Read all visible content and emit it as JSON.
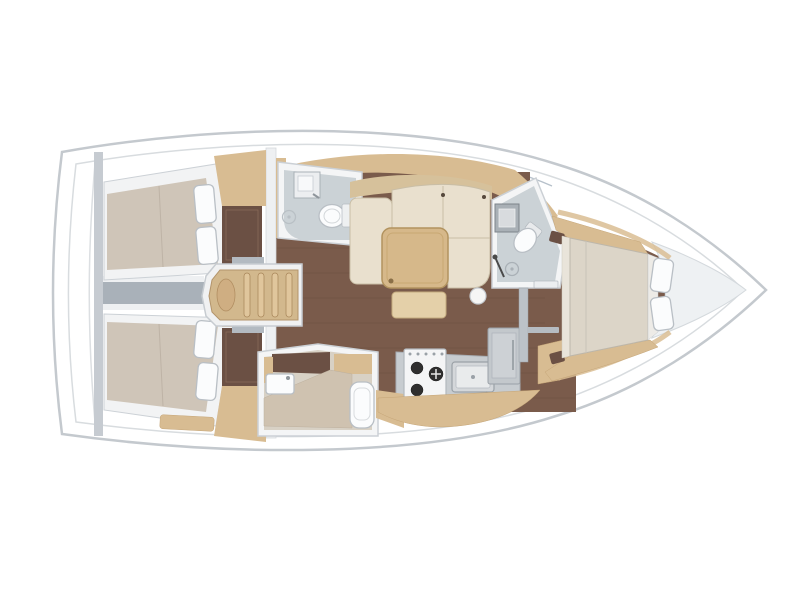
{
  "diagram": {
    "type": "sailboat-interior-floor-plan",
    "orientation": "bow-right",
    "rooms": [
      {
        "id": "aft-cabin-port",
        "fixtures": [
          "double-berth",
          "pillow",
          "pillow",
          "wardrobe",
          "locker-niche"
        ]
      },
      {
        "id": "aft-cabin-starboard",
        "fixtures": [
          "double-berth",
          "pillow",
          "pillow",
          "wardrobe",
          "locker-niche"
        ]
      },
      {
        "id": "companionway",
        "fixtures": [
          "steps"
        ]
      },
      {
        "id": "aft-head",
        "fixtures": [
          "sink",
          "toilet",
          "shower-drain"
        ]
      },
      {
        "id": "mid-head",
        "fixtures": [
          "sink",
          "toilet",
          "shower-bench"
        ]
      },
      {
        "id": "salon",
        "fixtures": [
          "l-sofa",
          "dining-table",
          "coffee-table",
          "stool"
        ]
      },
      {
        "id": "galley",
        "fixtures": [
          "stove",
          "sink",
          "fridge",
          "counter"
        ]
      },
      {
        "id": "forward-head",
        "fixtures": [
          "sink",
          "toilet",
          "shower-drain",
          "shower-wand"
        ]
      },
      {
        "id": "forward-cabin",
        "fixtures": [
          "double-berth",
          "pillow",
          "pillow",
          "bench",
          "bench"
        ]
      },
      {
        "id": "bow-locker",
        "fixtures": []
      }
    ]
  },
  "palette": {
    "deckWhite": "#ffffff",
    "hullLine": "#c4c9ce",
    "innerLine": "#d8dcdf",
    "floorWood": "#7a5b4b",
    "woodCabinet": "#d8bc92",
    "woodTable": "#d6b88a",
    "stepsWood": "#d2b88d",
    "mattressTaupe": "#cfc5b8",
    "mattressCream": "#dcd5c8",
    "sofaCream": "#e9e0ce",
    "sofaBack": "#d6c19b",
    "bathFloor": "#cbd2d6",
    "applianceGray": "#c7ccd0",
    "bulkheadGray": "#a9b1b9",
    "nicheBrown": "#6b5044",
    "bowShade": "#eef1f3",
    "wallWhite": "#f4f5f6"
  }
}
